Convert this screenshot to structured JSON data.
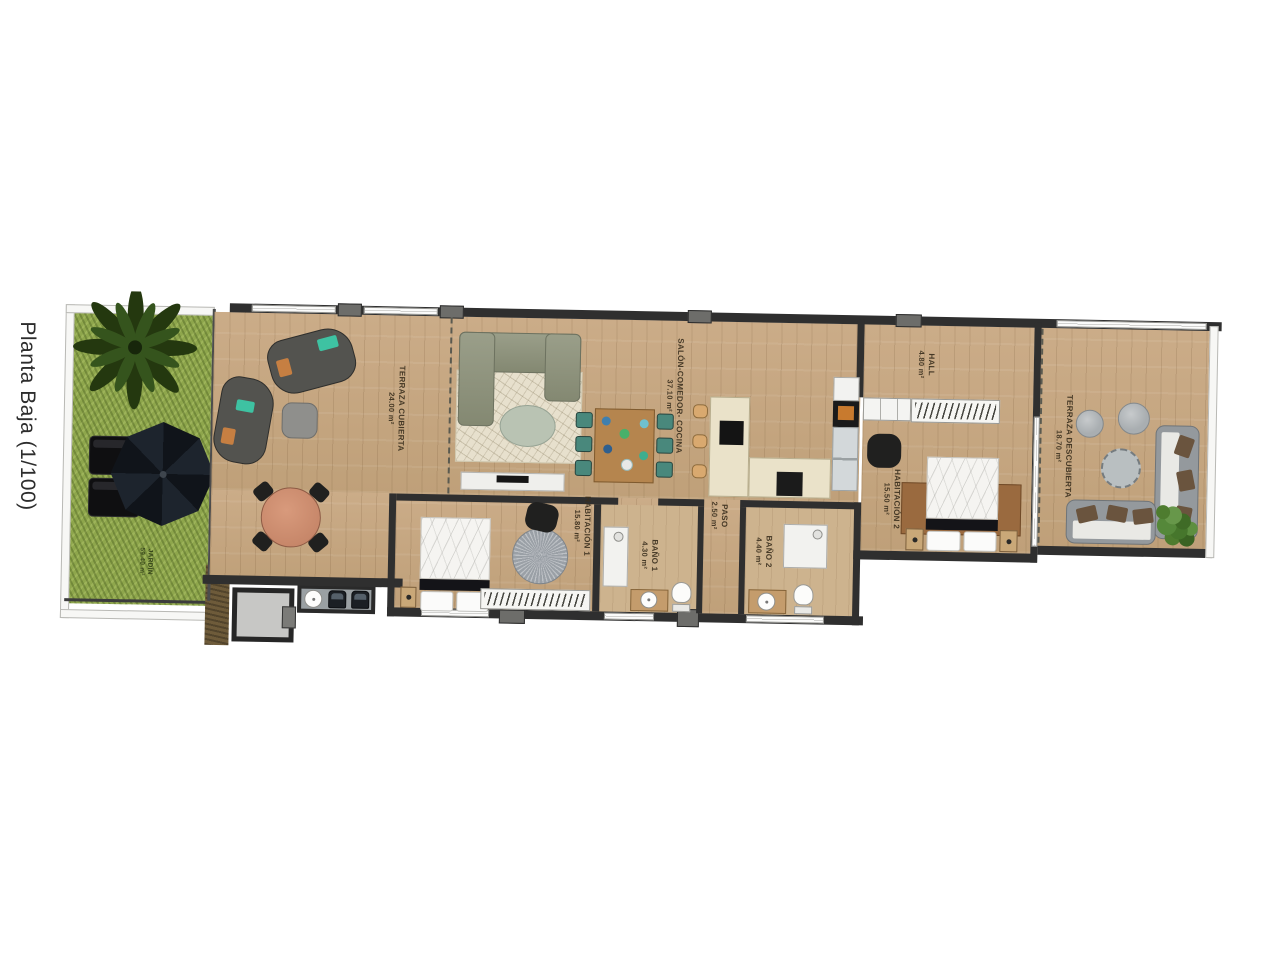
{
  "title": "Planta Baja (1/100)",
  "rooms": {
    "jardin": {
      "name": "JARDÍN",
      "area": "59.40 m²"
    },
    "terraza_cubierta": {
      "name": "TERRAZA CUBIERTA",
      "area": "24.00 m²"
    },
    "salon": {
      "name": "SALÓN-COMEDOR- COCINA",
      "area": "37.10 m²"
    },
    "hall": {
      "name": "HALL",
      "area": "4.80 m²"
    },
    "habitacion2": {
      "name": "HABITACIÓN 2",
      "area": "15.50 m²"
    },
    "terraza_descubierta": {
      "name": "TERRAZA DESCUBIERTA",
      "area": "18.70 m²"
    },
    "habitacion1": {
      "name": "HABITACIÓN 1",
      "area": "15.80 m²"
    },
    "paso": {
      "name": "PASO",
      "area": "2.50 m²"
    },
    "bano1": {
      "name": "BAÑO 1",
      "area": "4.30 m²"
    },
    "bano2": {
      "name": "BAÑO 2",
      "area": "4.40 m²"
    }
  },
  "colors": {
    "wall": "#2f2f2f",
    "wood": "#c5a782",
    "grass": "#8ea64c",
    "accent_teal": "#3ec2a2",
    "accent_orange": "#c67f42"
  }
}
